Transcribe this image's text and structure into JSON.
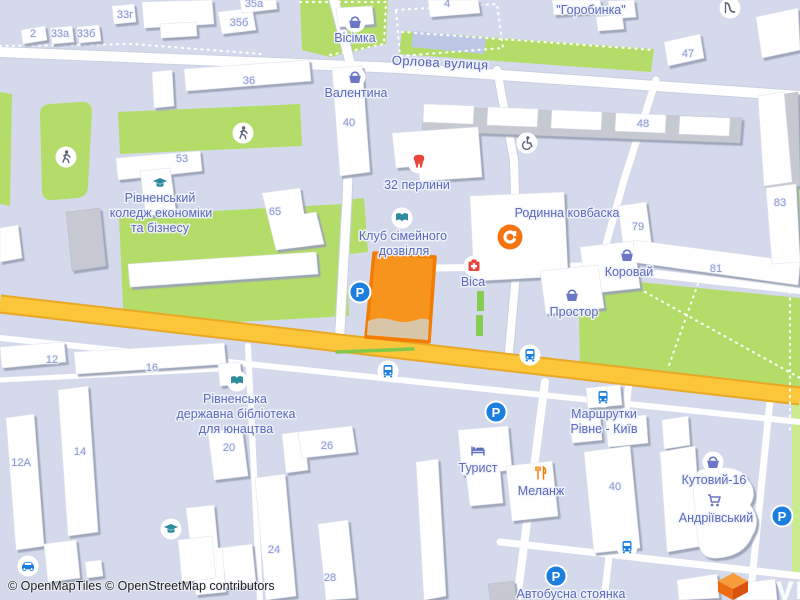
{
  "street": {
    "name": "Орлова вулиця"
  },
  "attribution": {
    "text": "© OpenMapTiles © OpenStreetMap contributors"
  },
  "logo": {
    "text": "лун"
  },
  "icons": {
    "parking_letter": "P"
  },
  "colors": {
    "selected_fill": "#F6941E",
    "selected_stroke": "#F27C02",
    "selected_base": "#D9C6A8",
    "road_major": "#FCC63A",
    "road_major_casing": "#E9A825",
    "park": "#B3DD68",
    "park_light": "#CBEC8E",
    "basket": "#6B77C6",
    "teal": "#2D8C9E",
    "red": "#E8453C",
    "orange": "#F57C00",
    "blue": "#1C7FE0",
    "person": "#5B6576",
    "label": "#5C69BE",
    "number": "#8C95CE"
  },
  "building_numbers": [
    {
      "t": "2",
      "x": 33,
      "y": 37
    },
    {
      "t": "33а",
      "x": 60,
      "y": 37
    },
    {
      "t": "33б",
      "x": 86,
      "y": 37
    },
    {
      "t": "33г",
      "x": 125,
      "y": 18
    },
    {
      "t": "35а",
      "x": 254,
      "y": 7
    },
    {
      "t": "35б",
      "x": 239,
      "y": 26
    },
    {
      "t": "4",
      "x": 447,
      "y": 7
    },
    {
      "t": "36",
      "x": 249,
      "y": 84
    },
    {
      "t": "40",
      "x": 349,
      "y": 126
    },
    {
      "t": "47",
      "x": 688,
      "y": 57
    },
    {
      "t": "48",
      "x": 643,
      "y": 127
    },
    {
      "t": "53",
      "x": 182,
      "y": 162
    },
    {
      "t": "65",
      "x": 275,
      "y": 215
    },
    {
      "t": "79",
      "x": 638,
      "y": 230
    },
    {
      "t": "81",
      "x": 716,
      "y": 272
    },
    {
      "t": "83",
      "x": 780,
      "y": 206
    },
    {
      "t": "12",
      "x": 52,
      "y": 363
    },
    {
      "t": "16",
      "x": 152,
      "y": 371
    },
    {
      "t": "14",
      "x": 80,
      "y": 455
    },
    {
      "t": "12А",
      "x": 21,
      "y": 466
    },
    {
      "t": "20",
      "x": 229,
      "y": 451
    },
    {
      "t": "24",
      "x": 274,
      "y": 553
    },
    {
      "t": "26",
      "x": 327,
      "y": 449
    },
    {
      "t": "28",
      "x": 330,
      "y": 581
    },
    {
      "t": "40",
      "x": 615,
      "y": 490
    }
  ],
  "pois": [
    {
      "id": "visimka",
      "icon": "basket",
      "ix": 355,
      "iy": 22,
      "lines": [
        {
          "t": "Вісімка",
          "x": 355,
          "y": 42
        }
      ]
    },
    {
      "id": "valentyna",
      "icon": "basket",
      "ix": 355,
      "iy": 77,
      "lines": [
        {
          "t": "Валентина",
          "x": 356,
          "y": 97
        }
      ]
    },
    {
      "id": "horobynka",
      "icon": null,
      "lines": [
        {
          "t": "\"Горобинка\"",
          "x": 591,
          "y": 14
        }
      ]
    },
    {
      "id": "32-perlyny",
      "icon": "tooth",
      "ix": 419,
      "iy": 162,
      "lines": [
        {
          "t": "32 перлини",
          "x": 417,
          "y": 189
        }
      ]
    },
    {
      "id": "college",
      "icon": "gradcap",
      "ix": 160,
      "iy": 183,
      "lines": [
        {
          "t": "Рівненський",
          "x": 160,
          "y": 202
        },
        {
          "t": "коледж економіки",
          "x": 161,
          "y": 217
        },
        {
          "t": "та бізнесу",
          "x": 160,
          "y": 232
        }
      ]
    },
    {
      "id": "klub-dozvillia",
      "icon": "book",
      "ix": 402,
      "iy": 218,
      "lines": [
        {
          "t": "Клуб сімейного",
          "x": 403,
          "y": 240
        },
        {
          "t": "дозвілля",
          "x": 404,
          "y": 255
        }
      ]
    },
    {
      "id": "rodynna-kovbaska",
      "icon": "logo-c",
      "ix": 510,
      "iy": 237,
      "lines": [
        {
          "t": "Родинна ковбаска",
          "x": 567,
          "y": 217
        }
      ]
    },
    {
      "id": "visa",
      "icon": "medical",
      "ix": 474,
      "iy": 266,
      "lines": [
        {
          "t": "Віса",
          "x": 473,
          "y": 286
        }
      ]
    },
    {
      "id": "korovai",
      "icon": "basket",
      "ix": 627,
      "iy": 255,
      "lines": [
        {
          "t": "Коровай",
          "x": 629,
          "y": 276
        }
      ]
    },
    {
      "id": "prostor",
      "icon": "basket",
      "ix": 572,
      "iy": 295,
      "lines": [
        {
          "t": "Простор",
          "x": 574,
          "y": 316
        }
      ]
    },
    {
      "id": "marshrutky",
      "icon": "bus",
      "ix": 603,
      "iy": 397,
      "lines": [
        {
          "t": "Маршрутки",
          "x": 604,
          "y": 418
        },
        {
          "t": "Рівне - Київ",
          "x": 604,
          "y": 433
        }
      ]
    },
    {
      "id": "turyst",
      "icon": "bed",
      "ix": 478,
      "iy": 451,
      "lines": [
        {
          "t": "Турист",
          "x": 478,
          "y": 472
        }
      ]
    },
    {
      "id": "melanzh",
      "icon": "food",
      "ix": 541,
      "iy": 473,
      "lines": [
        {
          "t": "Меланж",
          "x": 541,
          "y": 495
        }
      ]
    },
    {
      "id": "kutovyi-16",
      "icon": "basket",
      "ix": 713,
      "iy": 462,
      "lines": [
        {
          "t": "Кутовий-16",
          "x": 714,
          "y": 484
        }
      ]
    },
    {
      "id": "andriivskyi",
      "icon": "cart",
      "ix": 714,
      "iy": 500,
      "lines": [
        {
          "t": "Андріївський",
          "x": 716,
          "y": 522
        }
      ]
    },
    {
      "id": "avtobusna-stoianka",
      "icon": "parking",
      "ix": 556,
      "iy": 576,
      "lines": [
        {
          "t": "Автобусна стоянка",
          "x": 571,
          "y": 598
        }
      ]
    },
    {
      "id": "library",
      "icon": "book",
      "ix": 237,
      "iy": 381,
      "lines": [
        {
          "t": "Рівненська",
          "x": 235,
          "y": 403
        },
        {
          "t": "державна бібліотека",
          "x": 236,
          "y": 418
        },
        {
          "t": "для юнацтва",
          "x": 236,
          "y": 433
        }
      ]
    }
  ],
  "amenity_icons": [
    {
      "icon": "pedestrian",
      "x": 66,
      "y": 157
    },
    {
      "icon": "pedestrian",
      "x": 243,
      "y": 133
    },
    {
      "icon": "wheelchair",
      "x": 527,
      "y": 143
    },
    {
      "icon": "slide",
      "x": 730,
      "y": 8
    },
    {
      "icon": "parking",
      "x": 360,
      "y": 292
    },
    {
      "icon": "parking",
      "x": 496,
      "y": 412
    },
    {
      "icon": "parking",
      "x": 782,
      "y": 516
    },
    {
      "icon": "bus",
      "x": 530,
      "y": 355
    },
    {
      "icon": "bus",
      "x": 388,
      "y": 371
    },
    {
      "icon": "bus",
      "x": 627,
      "y": 547
    },
    {
      "icon": "car",
      "x": 28,
      "y": 566
    },
    {
      "icon": "gradcap",
      "x": 171,
      "y": 529
    }
  ]
}
